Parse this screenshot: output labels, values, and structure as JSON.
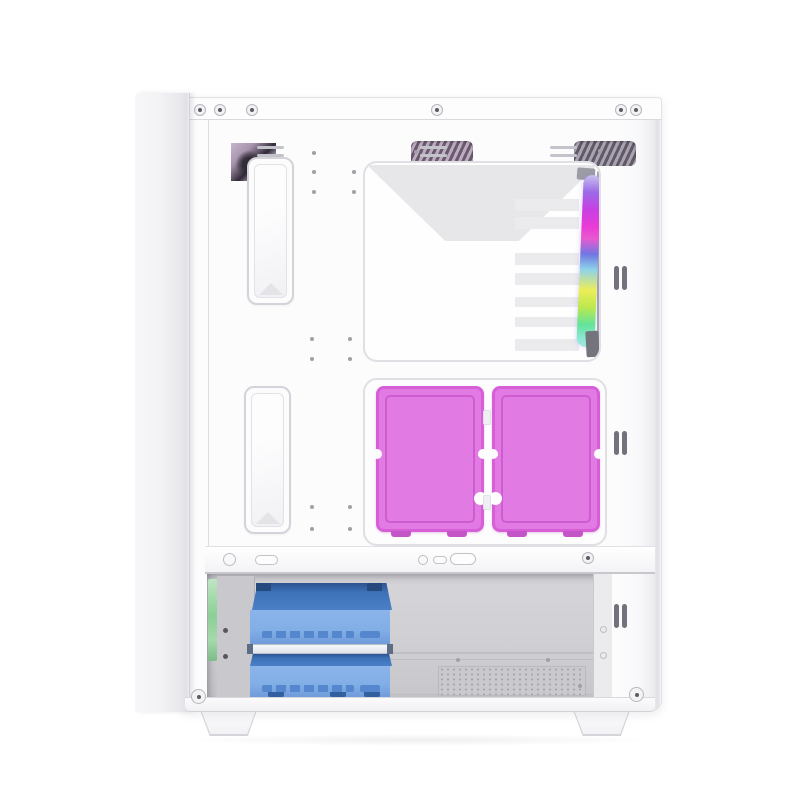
{
  "meta": {
    "type": "product-photo",
    "subject": "White mid-tower PC computer case shown from the open side with side panel removed, interior view"
  },
  "palette": {
    "background": "#ffffff",
    "case_white": "#fcfcfd",
    "front_panel_shade": "#e0e0e5",
    "vent_dark": "#675c6d",
    "vent_light_a": "#c0aac2",
    "vent_dark_b": "#5f5a66",
    "vent_light_b": "#aba2b1",
    "fan_hub_dark": "#2f2936",
    "fan_hub_light": "#c7b6cd",
    "ssd_tray_fill": "#e27ae3",
    "ssd_tray_border": "#d65fd7",
    "ssd_tray_tab": "#c455c6",
    "hdd_tray_front": "#82aee6",
    "hdd_tray_top": "#3d72b8",
    "hdd_tray_dark": "#2c5491",
    "hdd_dash": "#5587cf",
    "rail_light": "#dfe3ea",
    "compartment_gray": "#d6d6da",
    "compartment_floor": "#c6c6cb",
    "green_strip": "#8ccf96",
    "slot_dark": "#72727c",
    "screw_ring": "#b6b6bd",
    "screw_center": "#5b5b63"
  },
  "rgb_fan": {
    "gradient": [
      "#c7c2ee 0%",
      "#9b6ae8 10%",
      "#c93fe3 20%",
      "#ea3bd6 30%",
      "#e85ad0 37%",
      "#7077e2 46%",
      "#8fd3ea 55%",
      "#ecee58 67%",
      "#bce84e 77%",
      "#62e39a 87%",
      "#8ce8d2 95%",
      "#a0e8e0 100%"
    ]
  },
  "components": {
    "front_panel_count": 1,
    "top_vent_count": 2,
    "top_corner_fan_count": 1,
    "argb_fan_count": 1,
    "cable_cover_count": 2,
    "motherboard_cutout_count": 1,
    "ssd_tray_count": 2,
    "hdd_tray_count": 2,
    "case_feet_count": 2
  }
}
